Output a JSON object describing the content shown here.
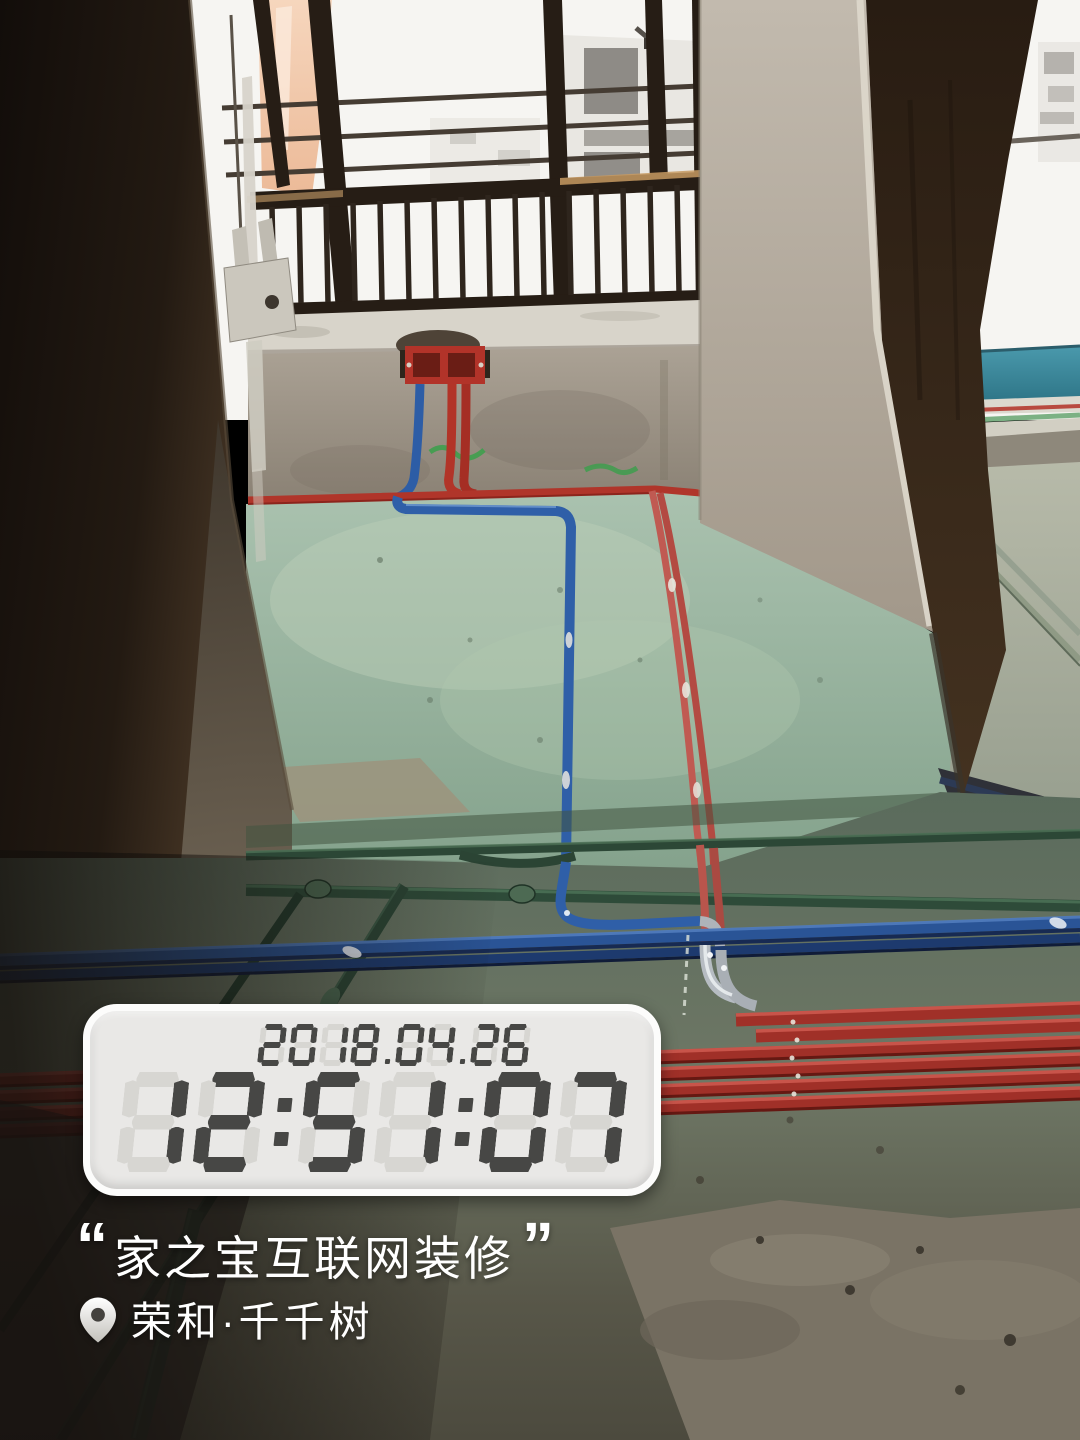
{
  "colors": {
    "red_conduit": "#b0352a",
    "blue_conduit": "#2f5fa8",
    "green_pipe": "#2e4b39",
    "floor_green": "#9ebda9",
    "teal_wall": "#3e8b9e",
    "clock_body": "#e9e8e6",
    "clock_segment_lit": "#474745",
    "clock_segment_ghost": "#d7d6d2",
    "watermark_text": "#ffffff"
  },
  "clock": {
    "date": "2018.04.26",
    "time": "12:51:07"
  },
  "watermark": {
    "quote_open": "“",
    "quote_close": "”",
    "caption": "家之宝互联网装修",
    "location": "荣和·千千树",
    "location_icon": "map-pin-icon"
  }
}
